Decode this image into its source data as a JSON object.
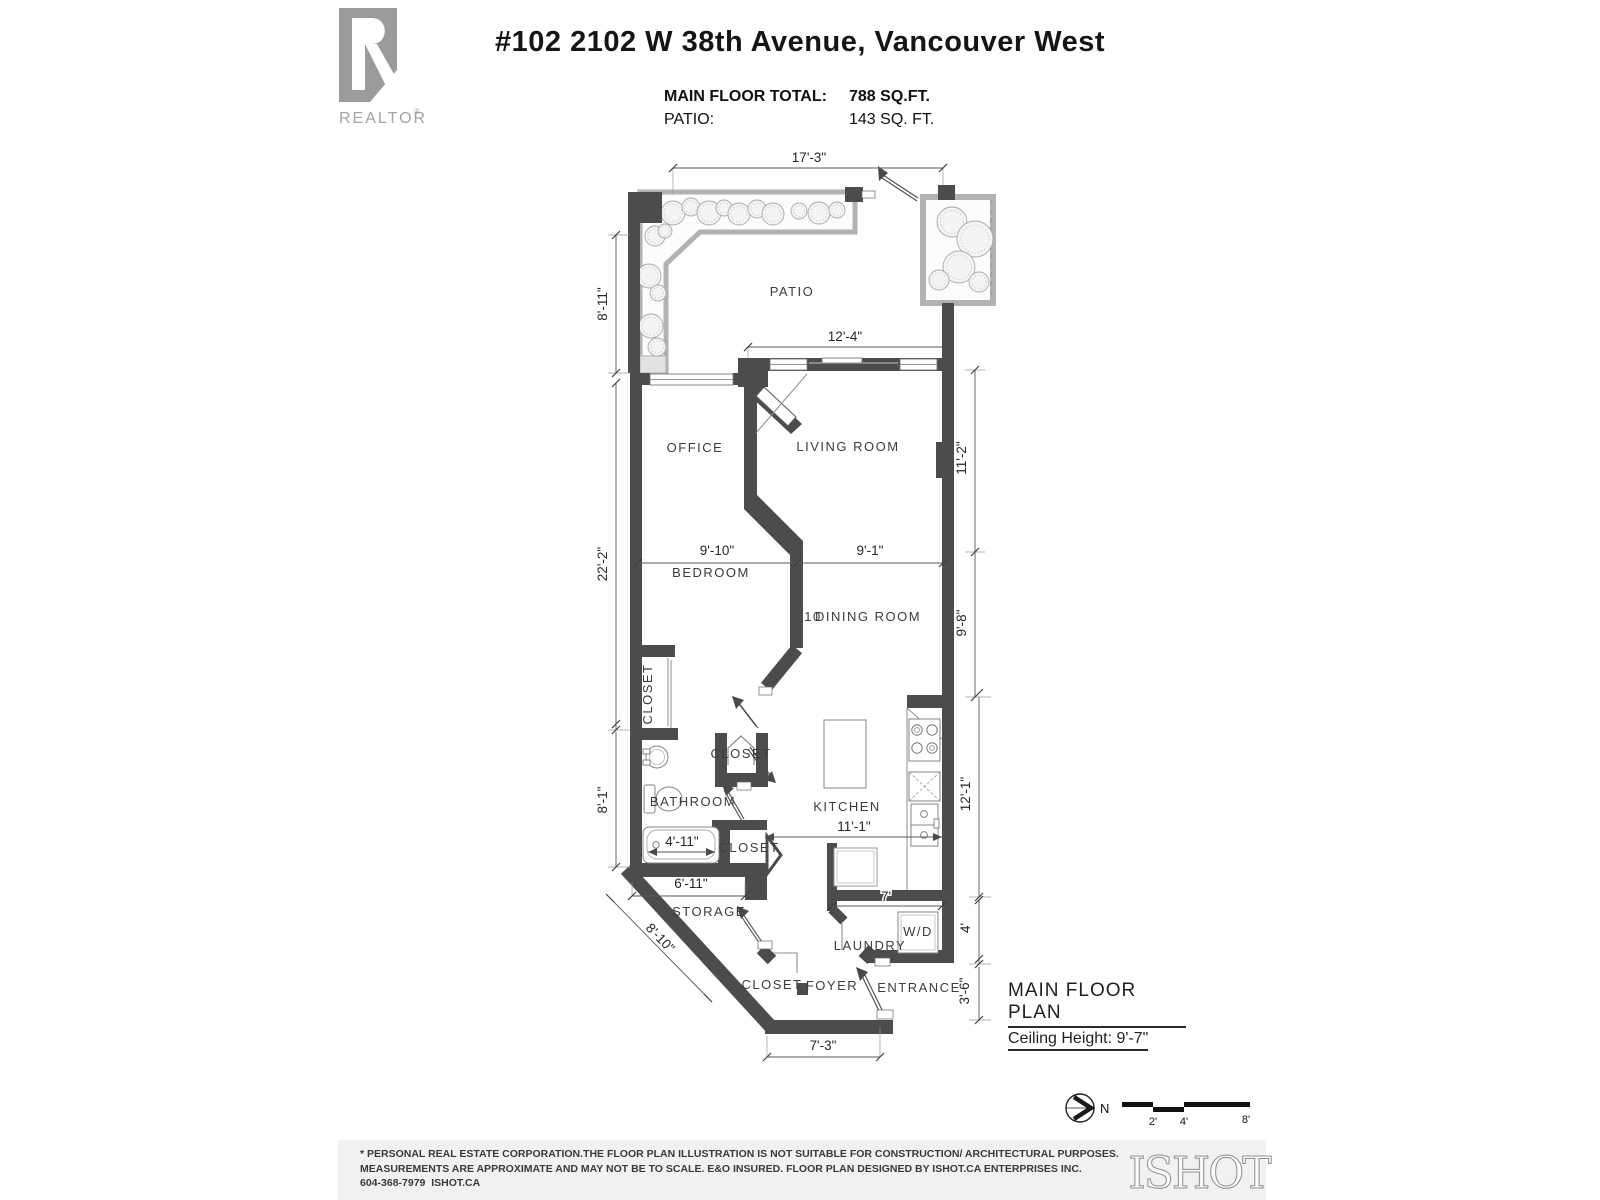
{
  "header": {
    "address": "#102 2102 W 38th Avenue, Vancouver West",
    "stats": [
      {
        "label": "MAIN FLOOR TOTAL:",
        "value": "788 SQ.FT."
      },
      {
        "label": "PATIO:",
        "value": "143 SQ. FT."
      }
    ]
  },
  "realtor_logo": {
    "text": "REALTOR",
    "reg": "®"
  },
  "rooms": {
    "patio": "PATIO",
    "office": "OFFICE",
    "living": "LIVING ROOM",
    "bedroom": "BEDROOM",
    "dining_num": "10",
    "dining": "DINING ROOM",
    "closet_bedroom": "CLOSET",
    "closet_mid": "CLOSET",
    "bathroom": "BATHROOM",
    "kitchen": "KITCHEN",
    "closet_bath": "CLOSET",
    "storage": "STORAGE",
    "laundry": "LAUNDRY",
    "wd": "W/D",
    "closet_foyer": "CLOSET",
    "foyer": "FOYER",
    "entrance": "ENTRANCE"
  },
  "dims": {
    "d17_3": "17'-3\"",
    "d8_11": "8'-11\"",
    "d12_4": "12'-4\"",
    "d22_2": "22'-2\"",
    "d11_2": "11'-2\"",
    "d9_10": "9'-10\"",
    "d9_1": "9'-1\"",
    "d9_8": "9'-8\"",
    "d8_1": "8'-1\"",
    "d4_11": "4'-11\"",
    "d11_1": "11'-1\"",
    "d12_1": "12'-1\"",
    "d6_11": "6'-11\"",
    "d8_10": "8'-10\"",
    "d7": "7'",
    "d4": "4'",
    "d3_6": "3'-6\"",
    "d7_3": "7'-3\""
  },
  "plan_title": {
    "name": "MAIN FLOOR PLAN",
    "ceiling": "Ceiling Height: 9'-7\""
  },
  "compass": {
    "label": "N"
  },
  "scale_bar": {
    "t2": "2'",
    "t4": "4'",
    "t8": "8'"
  },
  "footer": {
    "line1": "* PERSONAL REAL ESTATE CORPORATION.THE FLOOR PLAN ILLUSTRATION IS NOT SUITABLE FOR CONSTRUCTION/ ARCHITECTURAL PURPOSES.",
    "line2": "MEASUREMENTS ARE APPROXIMATE AND MAY NOT BE TO SCALE. E&O INSURED. FLOOR PLAN DESIGNED BY ISHOT.CA ENTERPRISES INC.",
    "line3": "604-368-7979  ISHOT.CA",
    "brand": "ISHOT"
  }
}
